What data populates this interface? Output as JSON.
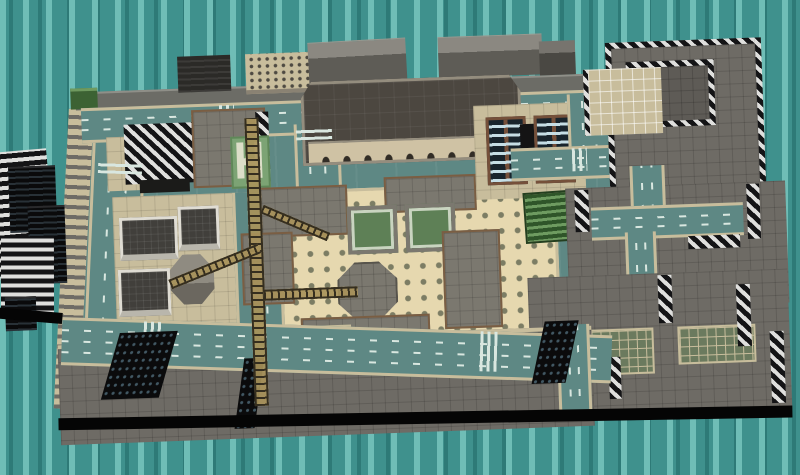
{
  "app": {
    "name": "3d-city-model-viewer",
    "view_label": "city map overview"
  },
  "viewport": {
    "width": 800,
    "height": 475
  },
  "scene": {
    "backdrop": "teal dashed grid",
    "objects": [
      "perimeter-wall",
      "elevated-ramp-west",
      "elevated-ramp-east",
      "tie-edge-ramp",
      "dark-office-block",
      "windowed-tan-block",
      "striped-roof-tower",
      "h-shaped-park",
      "white-trim-cube-buildings",
      "octagonal-tower",
      "central-hall-building",
      "arched-arcade-facade",
      "dotted-plaza",
      "octagonal-pavilion",
      "green-courtyards",
      "twin-glass-towers",
      "green-terraced-building",
      "tower-crane-lattice",
      "striped-skyscraper-top-right",
      "striped-skyscraper-cluster-west",
      "rooftop-courts",
      "big-flat-roofs",
      "black-window-walls",
      "roads-with-lane-dashes",
      "zebra-crosswalks",
      "ground-shadow"
    ]
  },
  "colors": {
    "bg_teal": "#3F918D",
    "bg_dash_light": "#6FBDB6",
    "bg_dash_dark": "#2E7A77",
    "road": "#5E8884",
    "lane": "#D9E7E0",
    "sidewalk": "#C8BD9C",
    "plaza": "#E6D8AF",
    "plaza_dot": "#7C7D64",
    "roof_gray": "#7B786F",
    "roof_big": "#6E6B65",
    "roof_brown": "#7A5E43",
    "wall_gray": "#6C6C66",
    "central_roof": "#4C4740",
    "central_trim": "#948D7E",
    "central_wall": "#CFC2A4",
    "central_arch": "#322D26",
    "stripe_dark": "#141416",
    "stripe_light": "#DFDFDD",
    "crane_tan": "#A8925A",
    "crane_dark": "#352E1F",
    "glass_frame": "#75503A",
    "glass_lite": "#C6DEE5",
    "glass_dark": "#18242C",
    "green_dark": "#2F5529",
    "green_light": "#6E9B60",
    "court_green": "#5E8056",
    "shadow_black": "#050505"
  }
}
